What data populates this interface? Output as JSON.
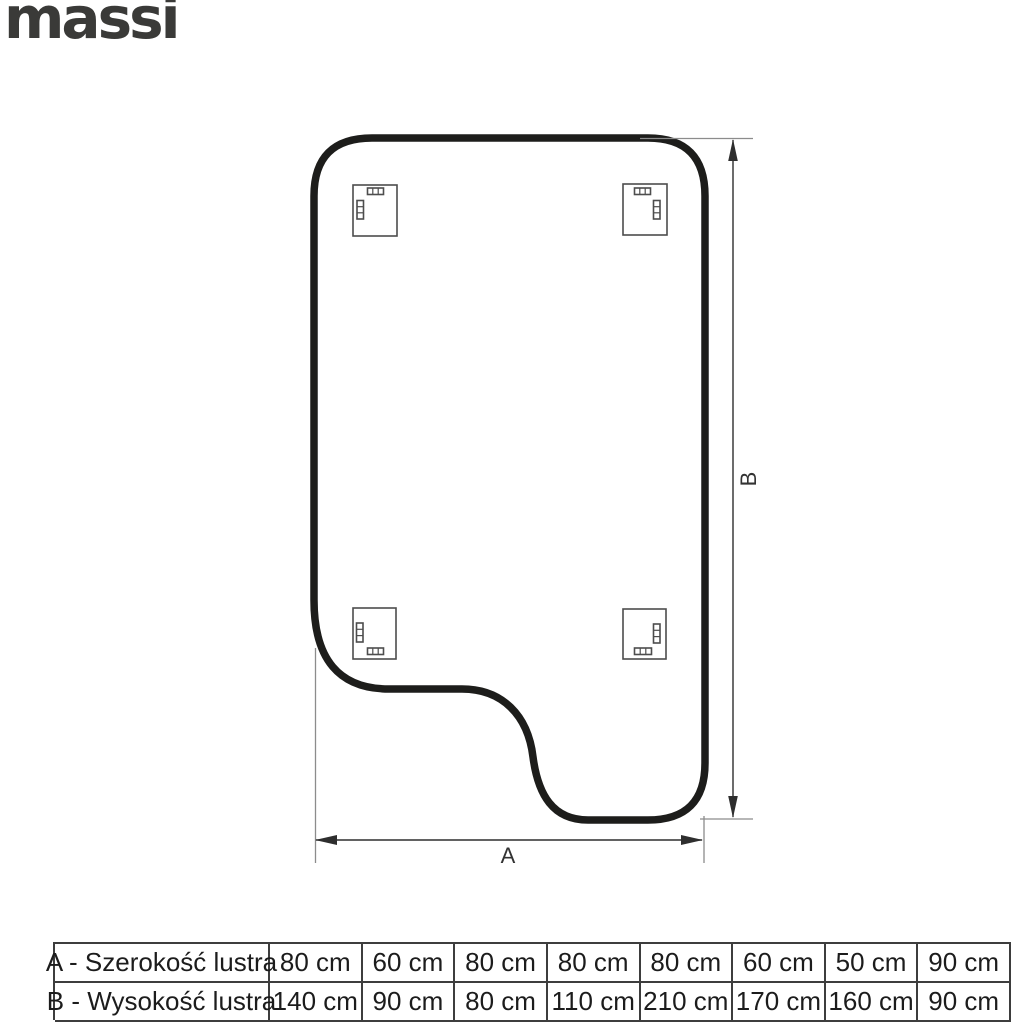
{
  "brand": {
    "logo_text": "massi"
  },
  "diagram": {
    "type": "mirror-technical-drawing-back-view",
    "width_label": "A",
    "height_label": "B",
    "mounting_brackets_count": 4
  },
  "colors": {
    "outline": "#1d1d1b",
    "thin_lines": "#4d4d4d",
    "extension_lines": "#8c8c8c",
    "logo": "#3a3a38",
    "table_border": "#3d3d3d",
    "text": "#1c1c1c",
    "background": "#ffffff"
  },
  "table": {
    "rows": [
      {
        "label": "A - Szerokość lustra",
        "values": [
          "80 cm",
          "60 cm",
          "80 cm",
          "80 cm",
          "80 cm",
          "60 cm",
          "50 cm",
          "90 cm"
        ]
      },
      {
        "label": "B - Wysokość lustra",
        "values": [
          "140 cm",
          "90 cm",
          "80 cm",
          "110 cm",
          "210 cm",
          "170 cm",
          "160 cm",
          "90 cm"
        ]
      }
    ]
  }
}
